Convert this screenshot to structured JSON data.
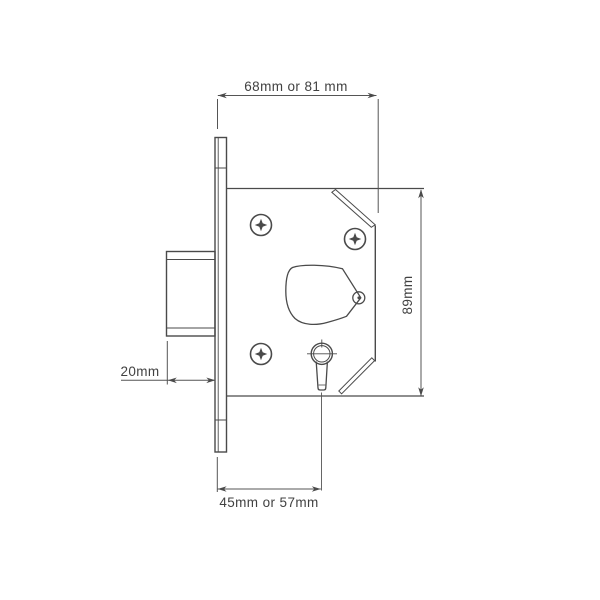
{
  "diagram": {
    "name": "Mortice deadlock dimension drawing",
    "dimensions": {
      "top": "68mm or 81 mm",
      "right": "89mm",
      "left": "20mm",
      "bottom": "45mm or 57mm"
    }
  },
  "colors": {
    "background": "#ffffff",
    "line": "#4a4a4a",
    "text": "#414141"
  }
}
